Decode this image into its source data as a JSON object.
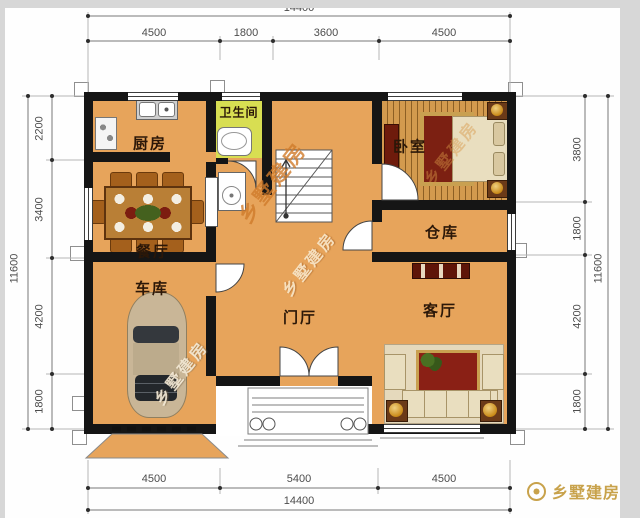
{
  "rooms": {
    "kitchen": "厨房",
    "bathroom": "卫生间",
    "bedroom": "卧室",
    "dining_room": "餐厅",
    "storage": "仓库",
    "garage": "车库",
    "foyer": "门厅",
    "living_room": "客厅"
  },
  "dim": {
    "top_total": "14400",
    "top_segs": [
      "4500",
      "1800",
      "3600",
      "4500"
    ],
    "bottom_segs": [
      "4500",
      "5400",
      "4500"
    ],
    "bottom_total": "14400",
    "left_segs": [
      "2200",
      "3400",
      "4200",
      "1800"
    ],
    "left_total": "11600",
    "right_segs": [
      "3800",
      "1800",
      "4200",
      "1800"
    ],
    "right_total": "11600"
  },
  "watermark": {
    "text": "乡墅建房"
  },
  "brand": {
    "logo_text": "乡墅建房"
  },
  "colors": {
    "floor": "#E7A45B",
    "bath_floor": "#D8DE52",
    "wall": "#151515",
    "wood": "#C9924A",
    "watermark_orange": "#D07F2E",
    "logo_gold": "#C8A24B"
  }
}
